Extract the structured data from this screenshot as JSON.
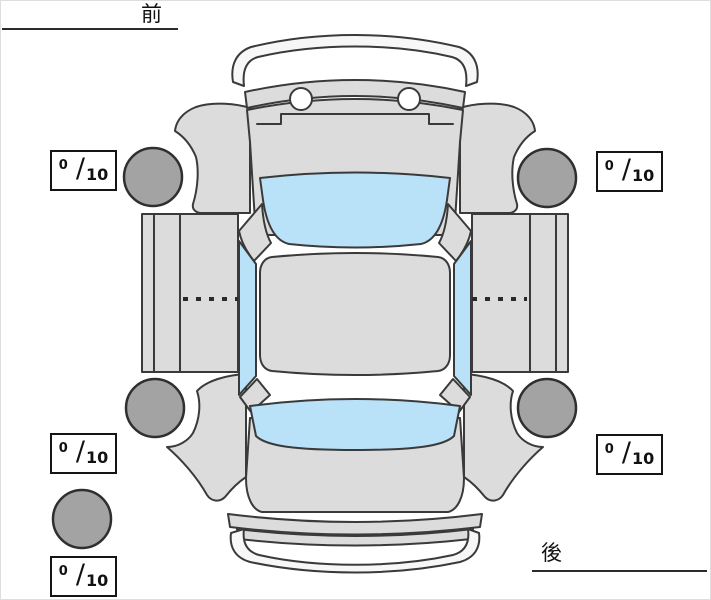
{
  "labels": {
    "front": "前",
    "rear": "後"
  },
  "scores": {
    "separator": "/",
    "front_left": {
      "value": "0",
      "max": "10"
    },
    "front_right": {
      "value": "0",
      "max": "10"
    },
    "rear_left": {
      "value": "0",
      "max": "10"
    },
    "rear_right": {
      "value": "0",
      "max": "10"
    },
    "spare": {
      "value": "0",
      "max": "10"
    }
  },
  "diagram": {
    "type": "car-top-view-tire-condition",
    "orientation": {
      "top": "front",
      "bottom": "rear"
    },
    "tires": [
      "front-left",
      "front-right",
      "rear-left",
      "rear-right",
      "spare"
    ],
    "colors": {
      "body": "#dcdcdc",
      "glass": "#b9e1f8",
      "tire": "#a3a3a3",
      "outline": "#3a3a3a",
      "background": "#ffffff"
    }
  }
}
